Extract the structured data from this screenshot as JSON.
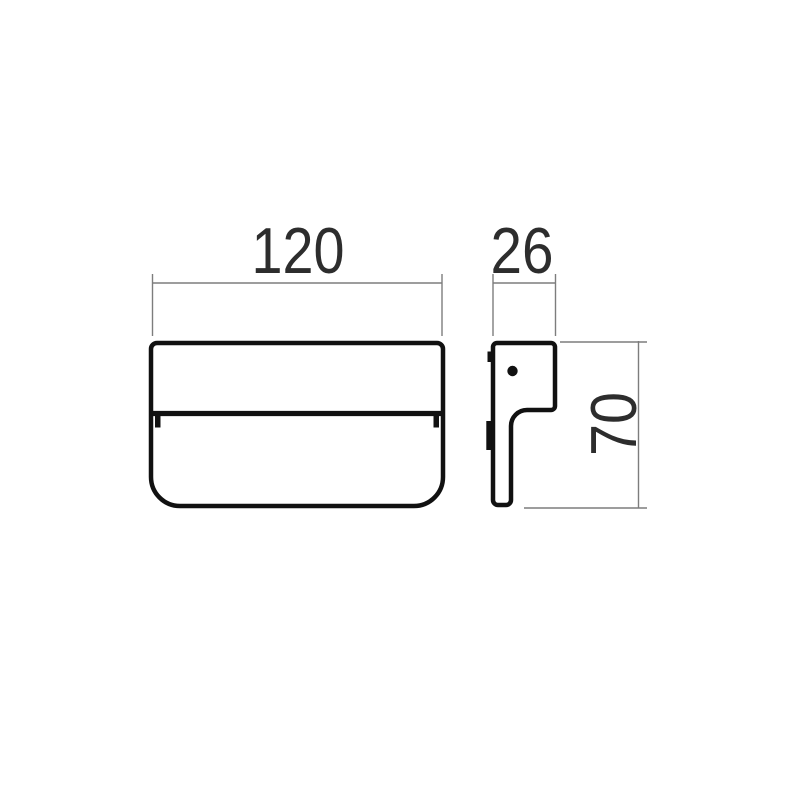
{
  "page": {
    "background_color": "#ffffff"
  },
  "drawing": {
    "title": "Technical dimension drawing of wall light fixture",
    "colors": {
      "outline": "#111111",
      "dim_line": "#7d7d7d",
      "dim_text": "#2d2d2d",
      "background": "#ffffff"
    },
    "views": {
      "front": {
        "name": "front view"
      },
      "side": {
        "name": "side profile view"
      }
    },
    "dimensions": {
      "width": {
        "value": "120",
        "orientation": "horizontal",
        "applies_to": "front view width"
      },
      "depth": {
        "value": "26",
        "orientation": "horizontal",
        "applies_to": "side view depth"
      },
      "height": {
        "value": "70",
        "orientation": "vertical-rotated",
        "applies_to": "side view height"
      }
    }
  }
}
